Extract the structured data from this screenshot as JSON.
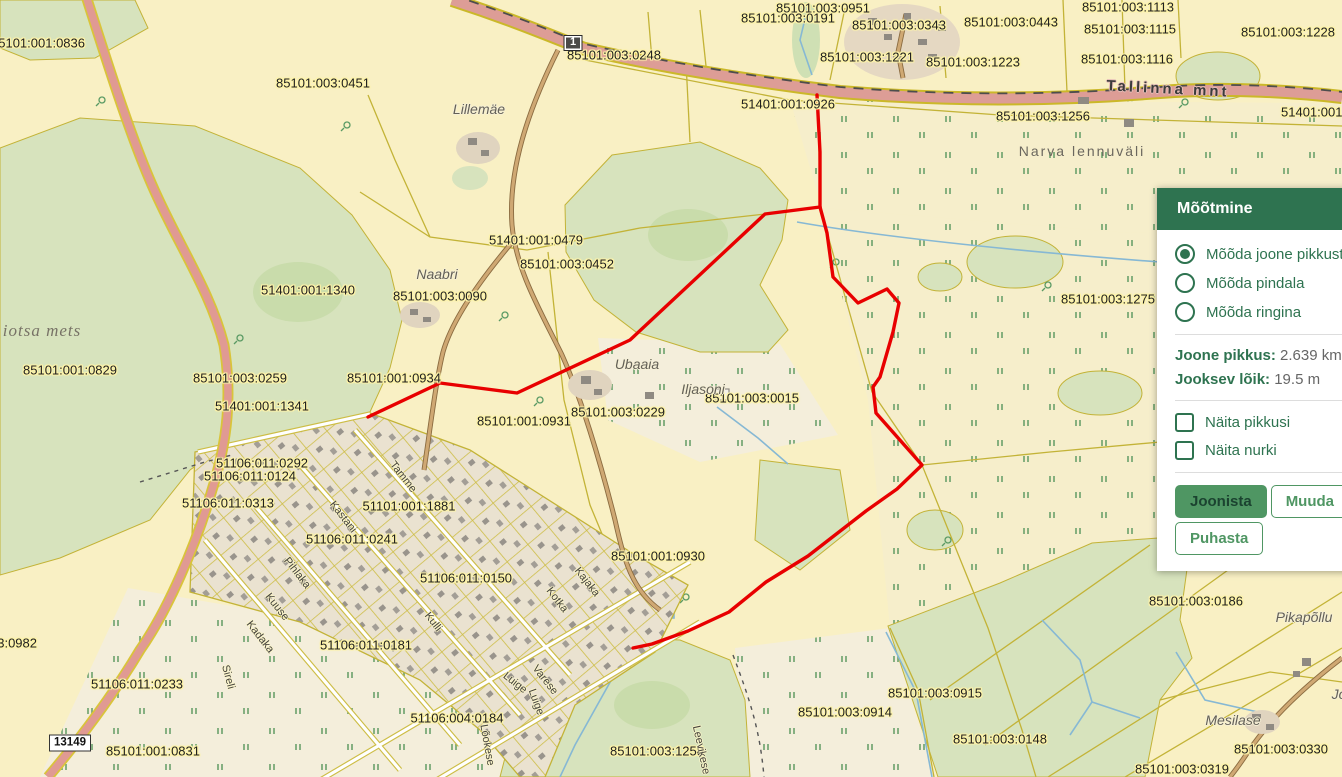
{
  "colors": {
    "accent": "#2e7350",
    "btn-green": "#4f9663",
    "red-line": "#e80000",
    "water": "#86b8d4",
    "pline": "#c3b337",
    "forest": "#d7e3bd",
    "field": "#f9f0c4",
    "road_pink": "#dd9d96",
    "road_casing": "#cbb829",
    "label_halo": "#fdf3a8"
  },
  "panel": {
    "title": "Mõõtmine",
    "radios": [
      {
        "label": "Mõõda joone pikkust",
        "selected": true
      },
      {
        "label": "Mõõda pindala",
        "selected": false
      },
      {
        "label": "Mõõda ringina",
        "selected": false
      }
    ],
    "stats": [
      {
        "label": "Joone pikkus:",
        "value": "2.639 km"
      },
      {
        "label": "Jooksev lõik:",
        "value": "19.5 m"
      }
    ],
    "checkboxes": [
      {
        "label": "Näita pikkusi",
        "checked": false
      },
      {
        "label": "Näita nurki",
        "checked": false
      }
    ],
    "buttons": [
      {
        "label": "Joonista",
        "variant": "primary"
      },
      {
        "label": "Muuda",
        "variant": "secondary"
      },
      {
        "label": "Puhasta",
        "variant": "secondary"
      }
    ]
  },
  "map": {
    "measurement_line_color": "#e80000",
    "road_shields": [
      {
        "text": "1",
        "x": 573,
        "y": 43,
        "style": "dark"
      },
      {
        "text": "13149",
        "x": 70,
        "y": 743,
        "style": "light"
      }
    ],
    "labels": [
      {
        "t": "85101:001:0836",
        "x": 38,
        "y": 43,
        "k": "parcel"
      },
      {
        "t": "85101:003:0951",
        "x": 823,
        "y": 8,
        "k": "parcel"
      },
      {
        "t": "85101:003:0191",
        "x": 788,
        "y": 18,
        "k": "parcel"
      },
      {
        "t": "85101:003:0343",
        "x": 899,
        "y": 25,
        "k": "parcel"
      },
      {
        "t": "85101:003:0443",
        "x": 1011,
        "y": 22,
        "k": "parcel"
      },
      {
        "t": "85101:003:1113",
        "x": 1128,
        "y": 7,
        "k": "parcel"
      },
      {
        "t": "85101:003:1115",
        "x": 1130,
        "y": 29,
        "k": "parcel"
      },
      {
        "t": "85101:003:1116",
        "x": 1127,
        "y": 59,
        "k": "parcel"
      },
      {
        "t": "85101:003:1228",
        "x": 1288,
        "y": 32,
        "k": "parcel"
      },
      {
        "t": "85101:003:1221",
        "x": 867,
        "y": 57,
        "k": "parcel"
      },
      {
        "t": "85101:003:1223",
        "x": 973,
        "y": 62,
        "k": "parcel"
      },
      {
        "t": "85101:003:0248",
        "x": 614,
        "y": 55,
        "k": "parcel"
      },
      {
        "t": "51401:001:0926",
        "x": 788,
        "y": 104,
        "k": "parcel"
      },
      {
        "t": "85101:003:1256",
        "x": 1043,
        "y": 116,
        "k": "parcel"
      },
      {
        "t": "51401:001:0926",
        "x": 1328,
        "y": 112,
        "k": "parcel"
      },
      {
        "t": "85101:003:0451",
        "x": 323,
        "y": 83,
        "k": "parcel"
      },
      {
        "t": "51401:001:0479",
        "x": 536,
        "y": 240,
        "k": "parcel"
      },
      {
        "t": "85101:003:0452",
        "x": 567,
        "y": 264,
        "k": "parcel"
      },
      {
        "t": "51401:001:1340",
        "x": 308,
        "y": 290,
        "k": "parcel"
      },
      {
        "t": "85101:003:0090",
        "x": 440,
        "y": 296,
        "k": "parcel"
      },
      {
        "t": "85101:001:0829",
        "x": 70,
        "y": 370,
        "k": "parcel"
      },
      {
        "t": "85101:003:0259",
        "x": 240,
        "y": 378,
        "k": "parcel"
      },
      {
        "t": "51401:001:1341",
        "x": 262,
        "y": 406,
        "k": "parcel"
      },
      {
        "t": "85101:001:0934",
        "x": 394,
        "y": 378,
        "k": "parcel"
      },
      {
        "t": "85101:003:0015",
        "x": 752,
        "y": 398,
        "k": "parcel"
      },
      {
        "t": "85101:003:0229",
        "x": 618,
        "y": 412,
        "k": "parcel"
      },
      {
        "t": "85101:001:0931",
        "x": 524,
        "y": 421,
        "k": "parcel"
      },
      {
        "t": "85101:003:1275",
        "x": 1108,
        "y": 299,
        "k": "parcel"
      },
      {
        "t": "51106:011:0292",
        "x": 262,
        "y": 463,
        "k": "parcel"
      },
      {
        "t": "51106:011:0124",
        "x": 250,
        "y": 476,
        "k": "parcel"
      },
      {
        "t": "51106:011:0313",
        "x": 228,
        "y": 503,
        "k": "parcel"
      },
      {
        "t": "51101:001:1881",
        "x": 409,
        "y": 506,
        "k": "parcel"
      },
      {
        "t": "51106:011:0241",
        "x": 352,
        "y": 539,
        "k": "parcel"
      },
      {
        "t": "51106:011:0150",
        "x": 466,
        "y": 578,
        "k": "parcel"
      },
      {
        "t": "85101:001:0930",
        "x": 658,
        "y": 556,
        "k": "parcel"
      },
      {
        "t": "51106:011:0181",
        "x": 366,
        "y": 645,
        "k": "parcel"
      },
      {
        "t": "51106:011:0233",
        "x": 137,
        "y": 684,
        "k": "parcel"
      },
      {
        "t": "51106:004:0184",
        "x": 457,
        "y": 718,
        "k": "parcel"
      },
      {
        "t": "85101:001:0831",
        "x": 153,
        "y": 751,
        "k": "parcel"
      },
      {
        "t": "85101:003:0982",
        "x": -10,
        "y": 643,
        "k": "parcel"
      },
      {
        "t": "85101:003:1258",
        "x": 657,
        "y": 751,
        "k": "parcel"
      },
      {
        "t": "85101:003:0915",
        "x": 935,
        "y": 693,
        "k": "parcel"
      },
      {
        "t": "85101:003:0914",
        "x": 845,
        "y": 712,
        "k": "parcel"
      },
      {
        "t": "85101:003:0148",
        "x": 1000,
        "y": 739,
        "k": "parcel"
      },
      {
        "t": "85101:003:0186",
        "x": 1196,
        "y": 601,
        "k": "parcel"
      },
      {
        "t": "85101:003:0330",
        "x": 1281,
        "y": 749,
        "k": "parcel"
      },
      {
        "t": "85101:003:0319",
        "x": 1182,
        "y": 769,
        "k": "parcel"
      },
      {
        "t": "85101:003:0",
        "x": 1320,
        "y": 556,
        "k": "parcel"
      },
      {
        "t": "Lillemäe",
        "x": 479,
        "y": 109,
        "k": "place"
      },
      {
        "t": "Naabri",
        "x": 437,
        "y": 274,
        "k": "place"
      },
      {
        "t": "Ubaaia",
        "x": 637,
        "y": 364,
        "k": "place"
      },
      {
        "t": "Iljasoni",
        "x": 703,
        "y": 389,
        "k": "place"
      },
      {
        "t": "Pikapõllu",
        "x": 1304,
        "y": 617,
        "k": "place"
      },
      {
        "t": "Mesilase",
        "x": 1233,
        "y": 720,
        "k": "place"
      },
      {
        "t": "Jo",
        "x": 1339,
        "y": 694,
        "k": "place"
      },
      {
        "t": "Narva lennuväli",
        "x": 1082,
        "y": 151,
        "k": "area"
      },
      {
        "t": "iotsa mets",
        "x": 42,
        "y": 331,
        "k": "place-lg"
      },
      {
        "t": "Tallinna mnt",
        "x": 1168,
        "y": 89,
        "k": "road",
        "r": 3
      },
      {
        "t": "Tamme",
        "x": 403,
        "y": 477,
        "k": "street",
        "r": 52
      },
      {
        "t": "Kastani",
        "x": 343,
        "y": 517,
        "k": "street",
        "r": 52
      },
      {
        "t": "Pihlaka",
        "x": 297,
        "y": 573,
        "k": "street",
        "r": 52
      },
      {
        "t": "Kuuse",
        "x": 277,
        "y": 607,
        "k": "street",
        "r": 52
      },
      {
        "t": "Kadaka",
        "x": 260,
        "y": 637,
        "k": "street",
        "r": 52
      },
      {
        "t": "Sireli",
        "x": 228,
        "y": 677,
        "k": "street",
        "r": 75
      },
      {
        "t": "Kulli",
        "x": 433,
        "y": 622,
        "k": "street",
        "r": 52
      },
      {
        "t": "Kotka",
        "x": 557,
        "y": 600,
        "k": "street",
        "r": 52
      },
      {
        "t": "Kajaka",
        "x": 587,
        "y": 582,
        "k": "street",
        "r": 52
      },
      {
        "t": "Varese",
        "x": 545,
        "y": 680,
        "k": "street",
        "r": 52
      },
      {
        "t": "Luige",
        "x": 515,
        "y": 683,
        "k": "street",
        "r": 38
      },
      {
        "t": "Luige",
        "x": 536,
        "y": 702,
        "k": "street",
        "r": 70
      },
      {
        "t": "Lõokese",
        "x": 487,
        "y": 745,
        "k": "street",
        "r": 80
      },
      {
        "t": "Leevikese",
        "x": 701,
        "y": 750,
        "k": "street",
        "r": 78
      }
    ]
  }
}
